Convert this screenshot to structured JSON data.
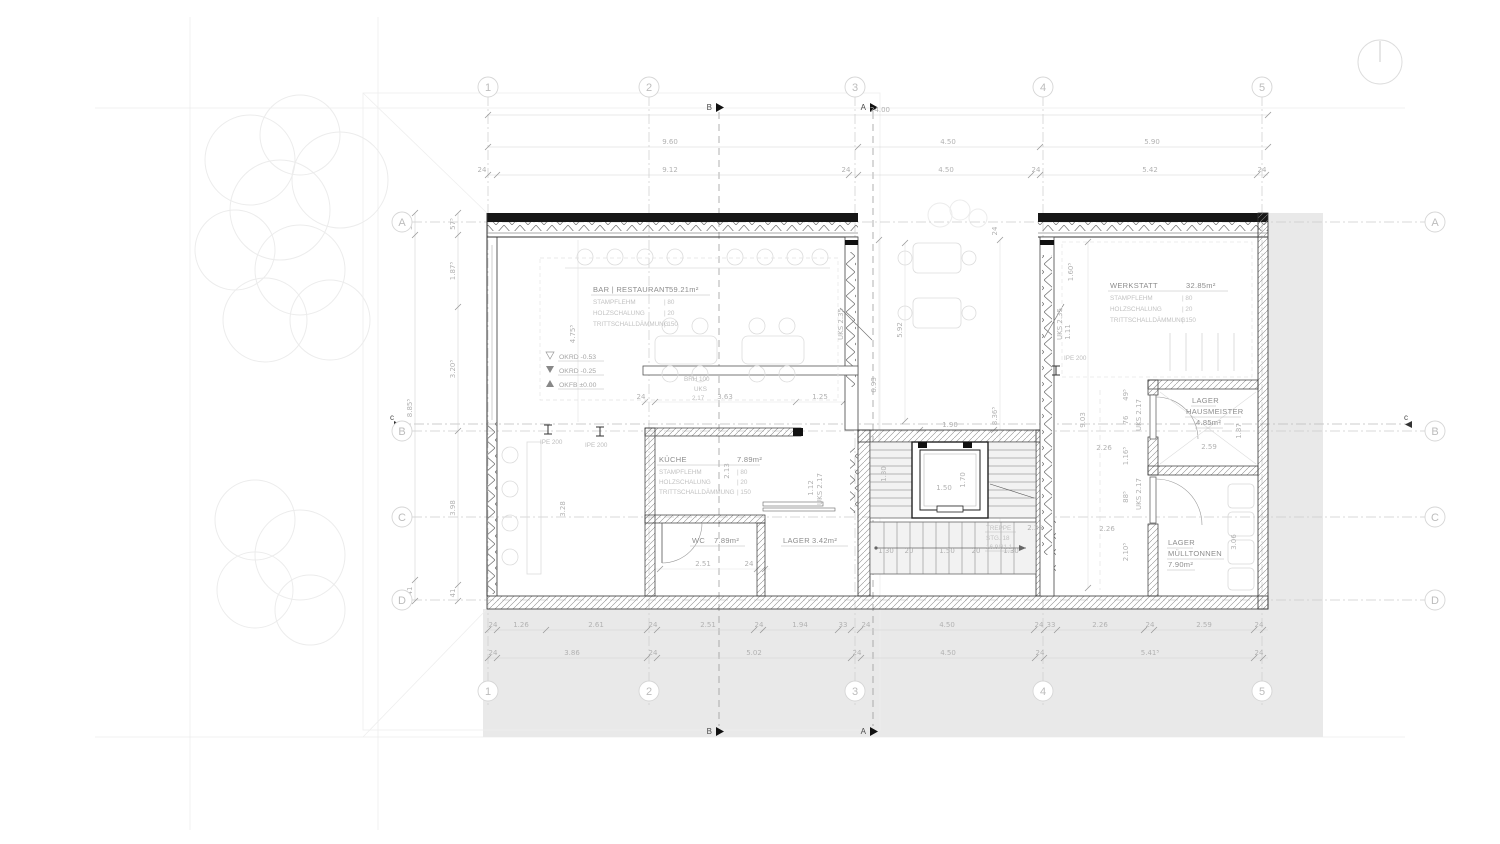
{
  "grid": {
    "cols": [
      "1",
      "2",
      "3",
      "4",
      "5"
    ],
    "rows": [
      "A",
      "B",
      "C",
      "D"
    ]
  },
  "sections": {
    "a": "A",
    "b": "B",
    "c": "c"
  },
  "dims": {
    "top1": [
      "24.00"
    ],
    "top2": [
      "9.60",
      "4.50",
      "5.90"
    ],
    "top3": [
      "24",
      "9.12",
      "24",
      "4.50",
      "24",
      "5.42",
      "24"
    ],
    "bottom1": [
      "24",
      "1.26",
      "2.61",
      "24",
      "2.51",
      "24",
      "1.94",
      "33",
      "24",
      "4.50",
      "24",
      "33",
      "2.26",
      "24",
      "2.59",
      "24"
    ],
    "bottom2": [
      "24",
      "3.86",
      "24",
      "5.02",
      "24",
      "4.50",
      "24",
      "5.41⁵",
      "24"
    ],
    "left_outer": [
      "57⁵",
      "8.85⁵",
      "41"
    ],
    "left_inner": [
      "57⁵",
      "1.87⁵",
      "3.20⁵",
      "3.98",
      "41"
    ],
    "stair": [
      "1.30",
      "20",
      "1.50",
      "20",
      "1.30"
    ]
  },
  "rooms": {
    "restaurant": {
      "name": "BAR | RESTAURANT",
      "area": "59.21m²",
      "layers": [
        {
          "n": "STAMPFLEHM",
          "v": "| 80"
        },
        {
          "n": "HOLZSCHALUNG",
          "v": "| 20"
        },
        {
          "n": "TRITTSCHALLDÄMMUNG",
          "v": "| 150"
        }
      ]
    },
    "werkstatt": {
      "name": "WERKSTATT",
      "area": "32.85m²",
      "layers": [
        {
          "n": "STAMPFLEHM",
          "v": "| 80"
        },
        {
          "n": "HOLZSCHALUNG",
          "v": "| 20"
        },
        {
          "n": "TRITTSCHALLDÄMMUNG",
          "v": "| 150"
        }
      ]
    },
    "kueche": {
      "name": "KÜCHE",
      "area": "7.89m²",
      "layers": [
        {
          "n": "STAMPFLEHM",
          "v": "| 80"
        },
        {
          "n": "HOLZSCHALUNG",
          "v": "| 20"
        },
        {
          "n": "TRITTSCHALLDÄMMUNG",
          "v": "| 150"
        }
      ]
    },
    "wc": {
      "name": "WC",
      "area": "7.89m²"
    },
    "lager": {
      "name": "LAGER",
      "area": "3.42m²"
    },
    "hausmeister": {
      "line1": "LAGER",
      "line2": "HAUSMEISTER",
      "area": "4.85m²"
    },
    "muelltonnen": {
      "line1": "LAGER",
      "line2": "MÜLLTONNEN",
      "area": "7.90m²"
    },
    "treppe": {
      "line1": "TREPPE",
      "line2": "STG. 18",
      "line3": "16.9/31.1"
    }
  },
  "levels": [
    {
      "sym": "▽",
      "label": "OKRD -0.53"
    },
    {
      "sym": "▼",
      "label": "OKRD -0.25"
    },
    {
      "sym": "▲",
      "label": "OKFB ±0.00"
    }
  ],
  "ann": {
    "ipe": "IPE 200",
    "brh": "BRH 100",
    "uks": "UKS",
    "uks_val": "2.17"
  },
  "inline": [
    "1.90",
    "5.92",
    "6.93",
    "8.36⁵",
    "9.03",
    "1.70",
    "1.50",
    "2.35",
    "2.51",
    "24",
    "2.59",
    "2.26",
    "2.26",
    "49⁵",
    "76",
    "1.16⁵",
    "88⁵",
    "2.10⁵",
    "1.87",
    "2.13",
    "1.12",
    "UKS 2.17",
    "UKS 2.17",
    "UKS 2.17",
    "UKS 2.35",
    "UKS 2.35",
    "1.11",
    "1.60⁵",
    "4.75⁵",
    "3.28",
    "3.63",
    "1.25",
    "24",
    "1.30",
    "3.06",
    "24"
  ]
}
